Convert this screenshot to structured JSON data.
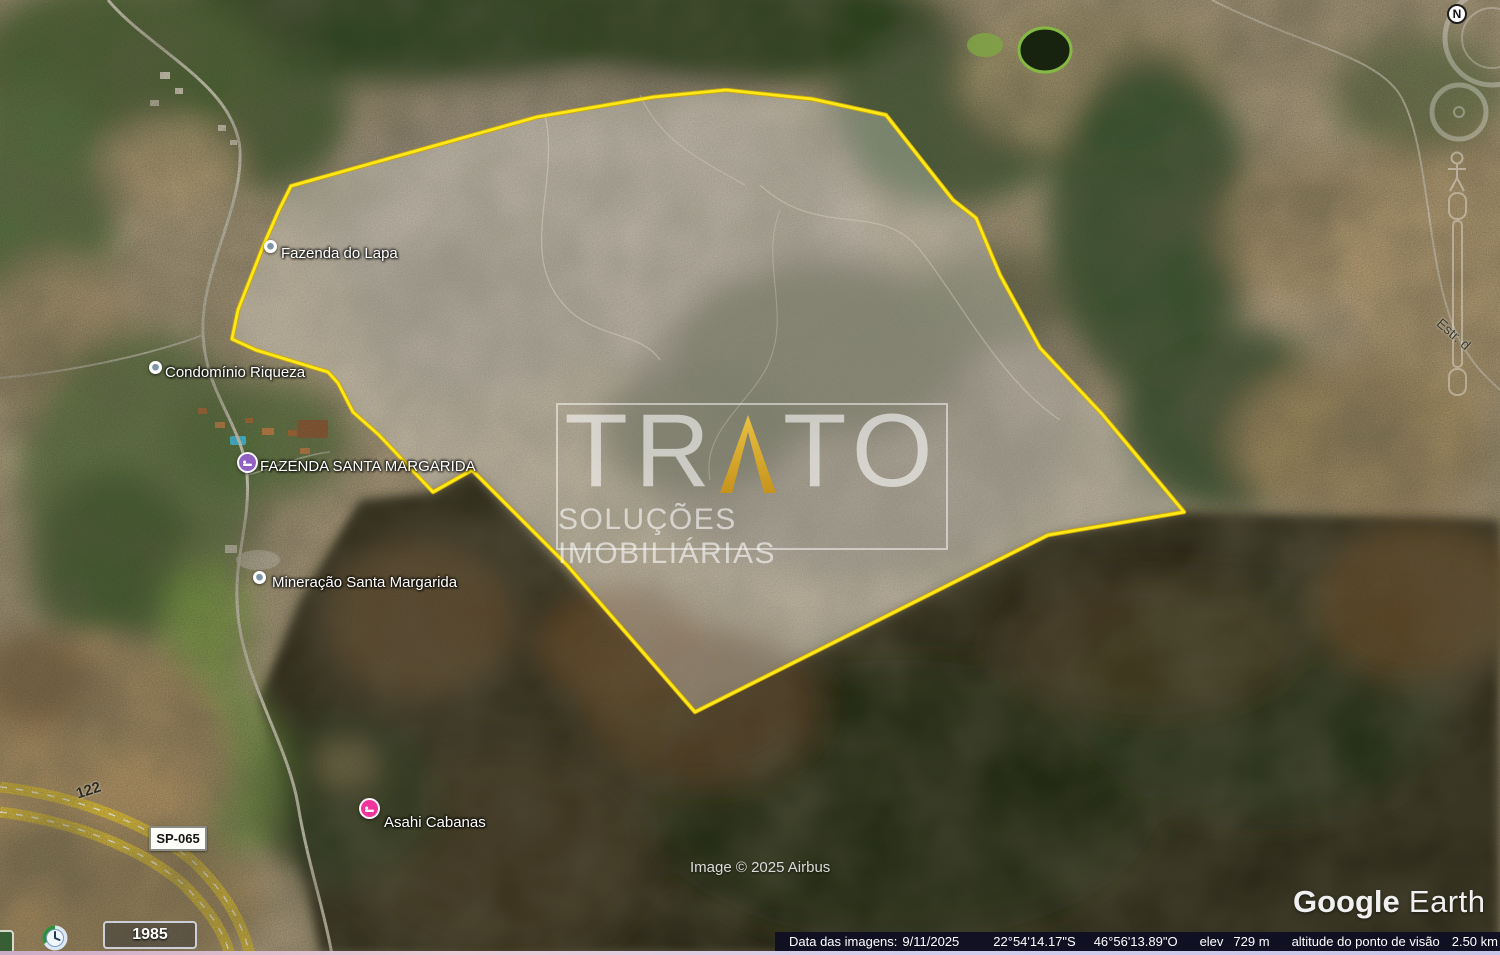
{
  "watermark": {
    "brand_left": "TR",
    "brand_right": "TO",
    "subtitle": "SOLUÇÕES IMOBILIÁRIAS",
    "accent_color": "#d9a92a"
  },
  "place_labels": {
    "fazenda_do_lapa": "Fazenda do Lapa",
    "condominio_riqueza": "Condomínio Riqueza",
    "fazenda_santa_margarida": "FAZENDA SANTA MARGARIDA",
    "mineracao_santa_margarida": "Mineração Santa Margarida",
    "asahi_cabanas": "Asahi Cabanas"
  },
  "roads": {
    "route_number": "122",
    "shield": "SP-065",
    "estrada": "Estr. d"
  },
  "attribution": {
    "copyright": "Image © 2025 Airbus",
    "logo_bold": "Google",
    "logo_light": " Earth"
  },
  "history": {
    "year": "1985"
  },
  "compass": {
    "north": "N"
  },
  "status_bar": {
    "imagery_date_label": "Data das imagens:",
    "imagery_date": "9/11/2025",
    "latitude": "22°54'14.17\"S",
    "longitude": "46°56'13.89\"O",
    "elev_label": "elev",
    "elevation": "729 m",
    "eye_alt_label": "altitude do ponto de visão",
    "eye_altitude": "2.50 km"
  },
  "colors": {
    "boundary_yellow": "#ffe817",
    "pin_purple": "#9061c2",
    "pin_pink": "#f1359b",
    "status_bar_bg": "#0e0e24"
  }
}
